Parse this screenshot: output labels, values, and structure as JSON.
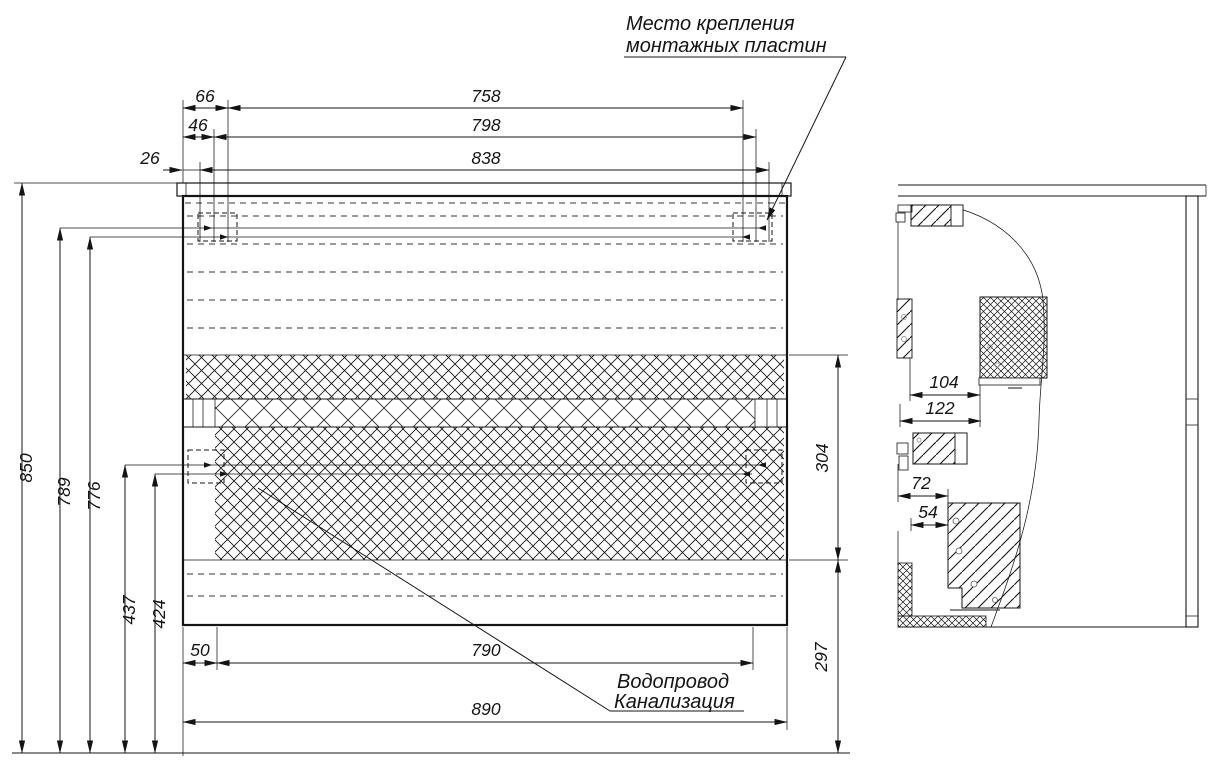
{
  "page": {
    "background": "#ffffff",
    "line_color": "#141414"
  },
  "annotations": {
    "mounting_plates_note": {
      "line1": "Место крепления",
      "line2": "монтажных пластин"
    },
    "plumbing_note": {
      "line1": "Водопровод",
      "line2": "Канализация"
    }
  },
  "dimensions": {
    "front_top": {
      "d66": "66",
      "d758": "758",
      "d46": "46",
      "d798": "798",
      "d26": "26",
      "d838": "838"
    },
    "front_left": {
      "d850": "850",
      "d789": "789",
      "d776": "776",
      "d437": "437",
      "d424": "424"
    },
    "front_bottom": {
      "d50": "50",
      "d790": "790",
      "d890": "890"
    },
    "front_right": {
      "d304": "304",
      "d297": "297"
    },
    "side_view": {
      "d104": "104",
      "d122": "122",
      "d72": "72",
      "d54": "54"
    }
  }
}
